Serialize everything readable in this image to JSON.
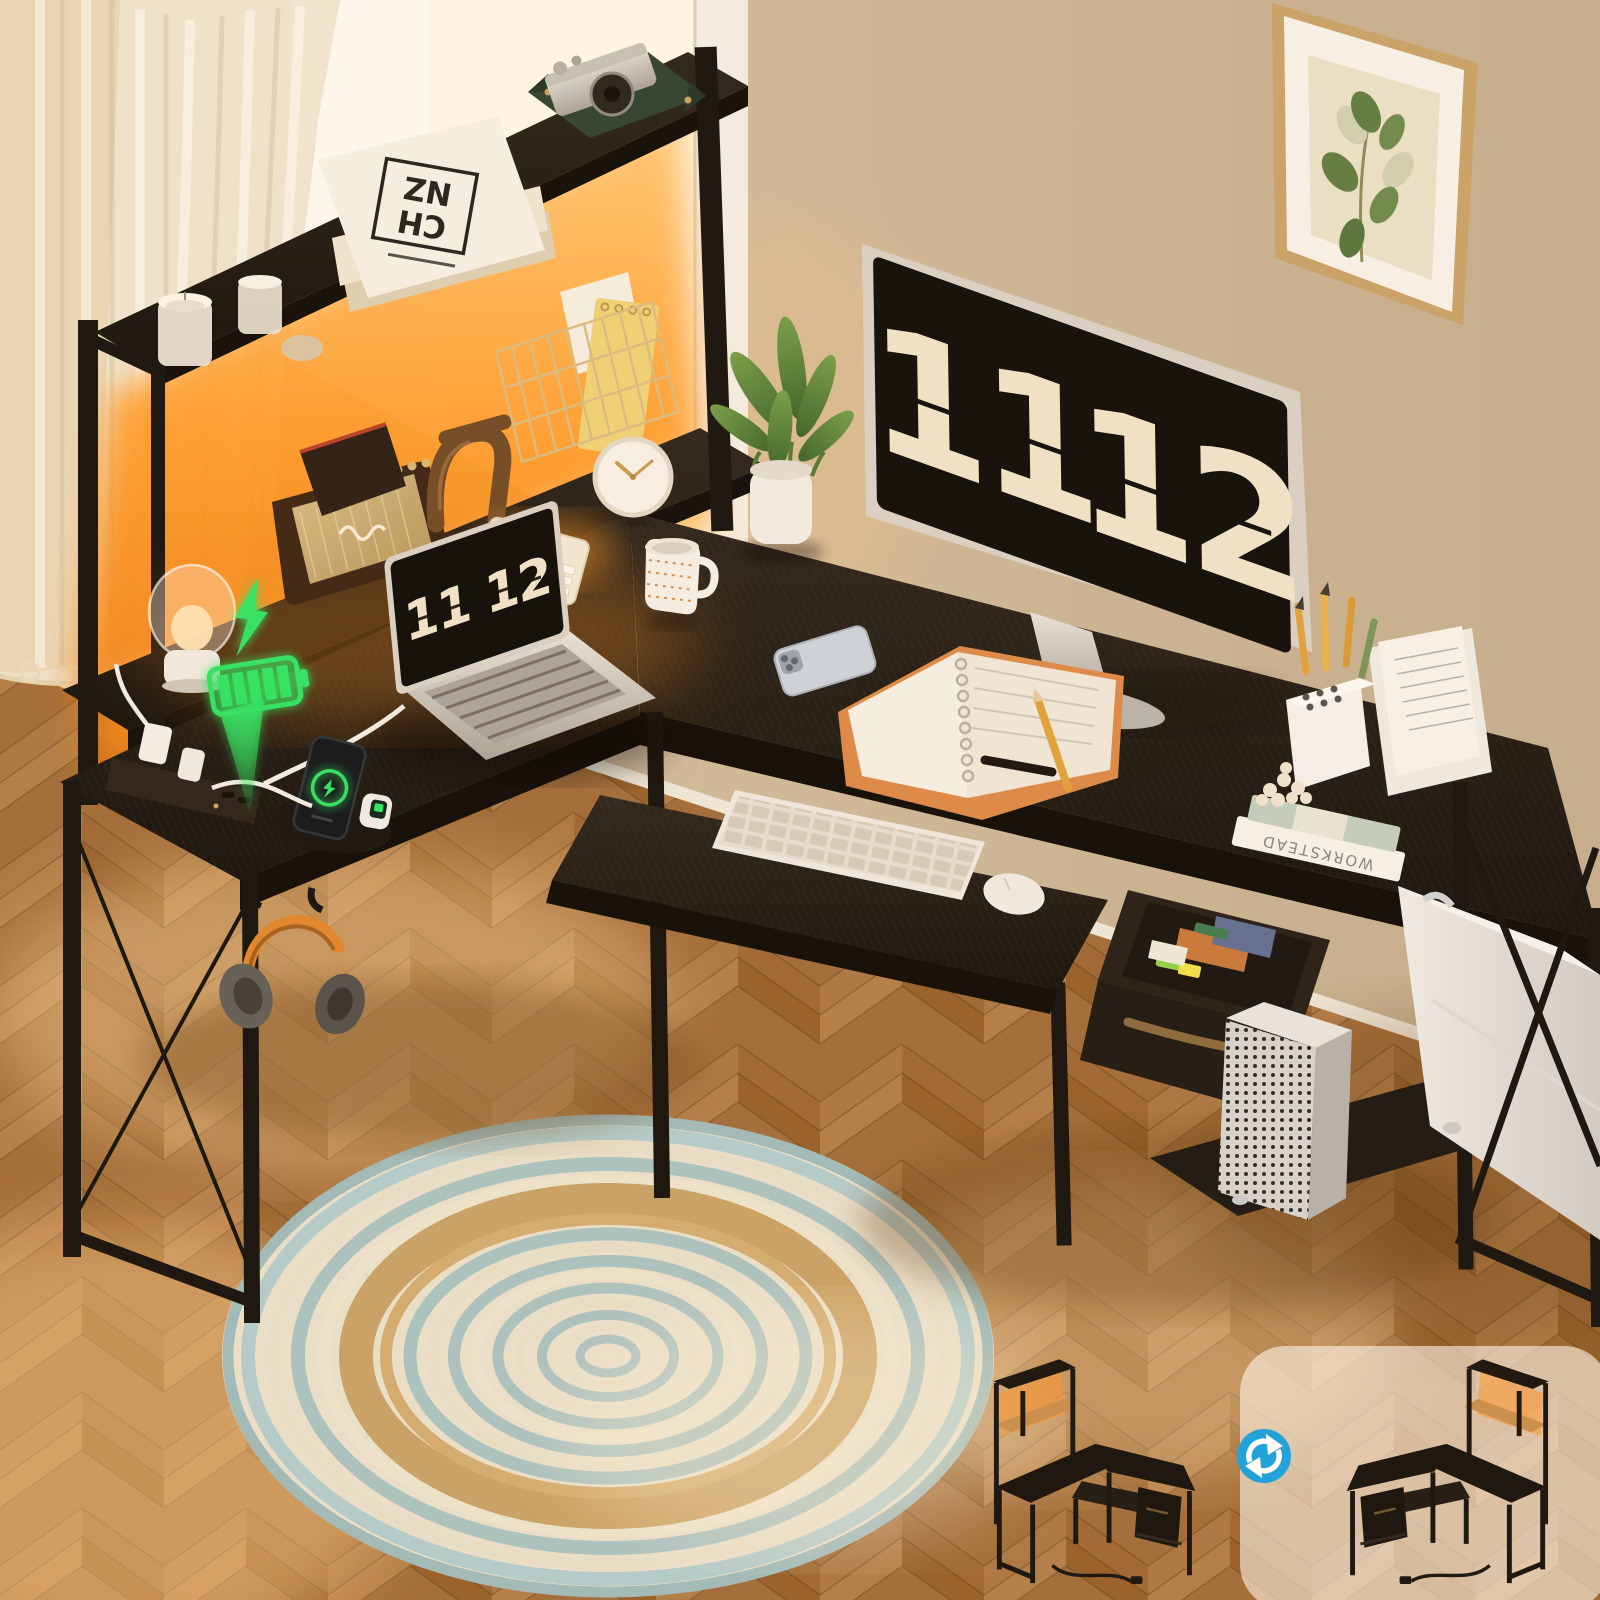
{
  "scene": {
    "description": "Product photo: black L-shaped computer desk with hutch shelves, orange LED lighting, built-in power strip, keyboard tray and open fabric drawer in a warm sunlit room with round braided rug",
    "monitor_clock": {
      "hours": "11",
      "minutes": "12"
    },
    "laptop_clock": {
      "text": "11 12"
    },
    "hutch_book_logo": {
      "line1": "CH",
      "line2": "NZ"
    },
    "desk_book_spine": "WORKSTEAD",
    "calculator_display": "23-658",
    "colors": {
      "led_glow": "#ff9224",
      "charging_green": "#2ee565",
      "swap_icon_blue": "#18a2e2",
      "desk_wood": "#17130f",
      "wall": "#cdb89d",
      "floor": "#b57e46",
      "rug_blue": "#a9c3c5",
      "rug_jute": "#c9a368",
      "headphones_orange": "#e0872f"
    },
    "icons": [
      "lightning-bolt-icon",
      "battery-charging-icon",
      "down-arrow-icon",
      "swap-arrows-icon",
      "phone-charging-ring-icon"
    ]
  }
}
